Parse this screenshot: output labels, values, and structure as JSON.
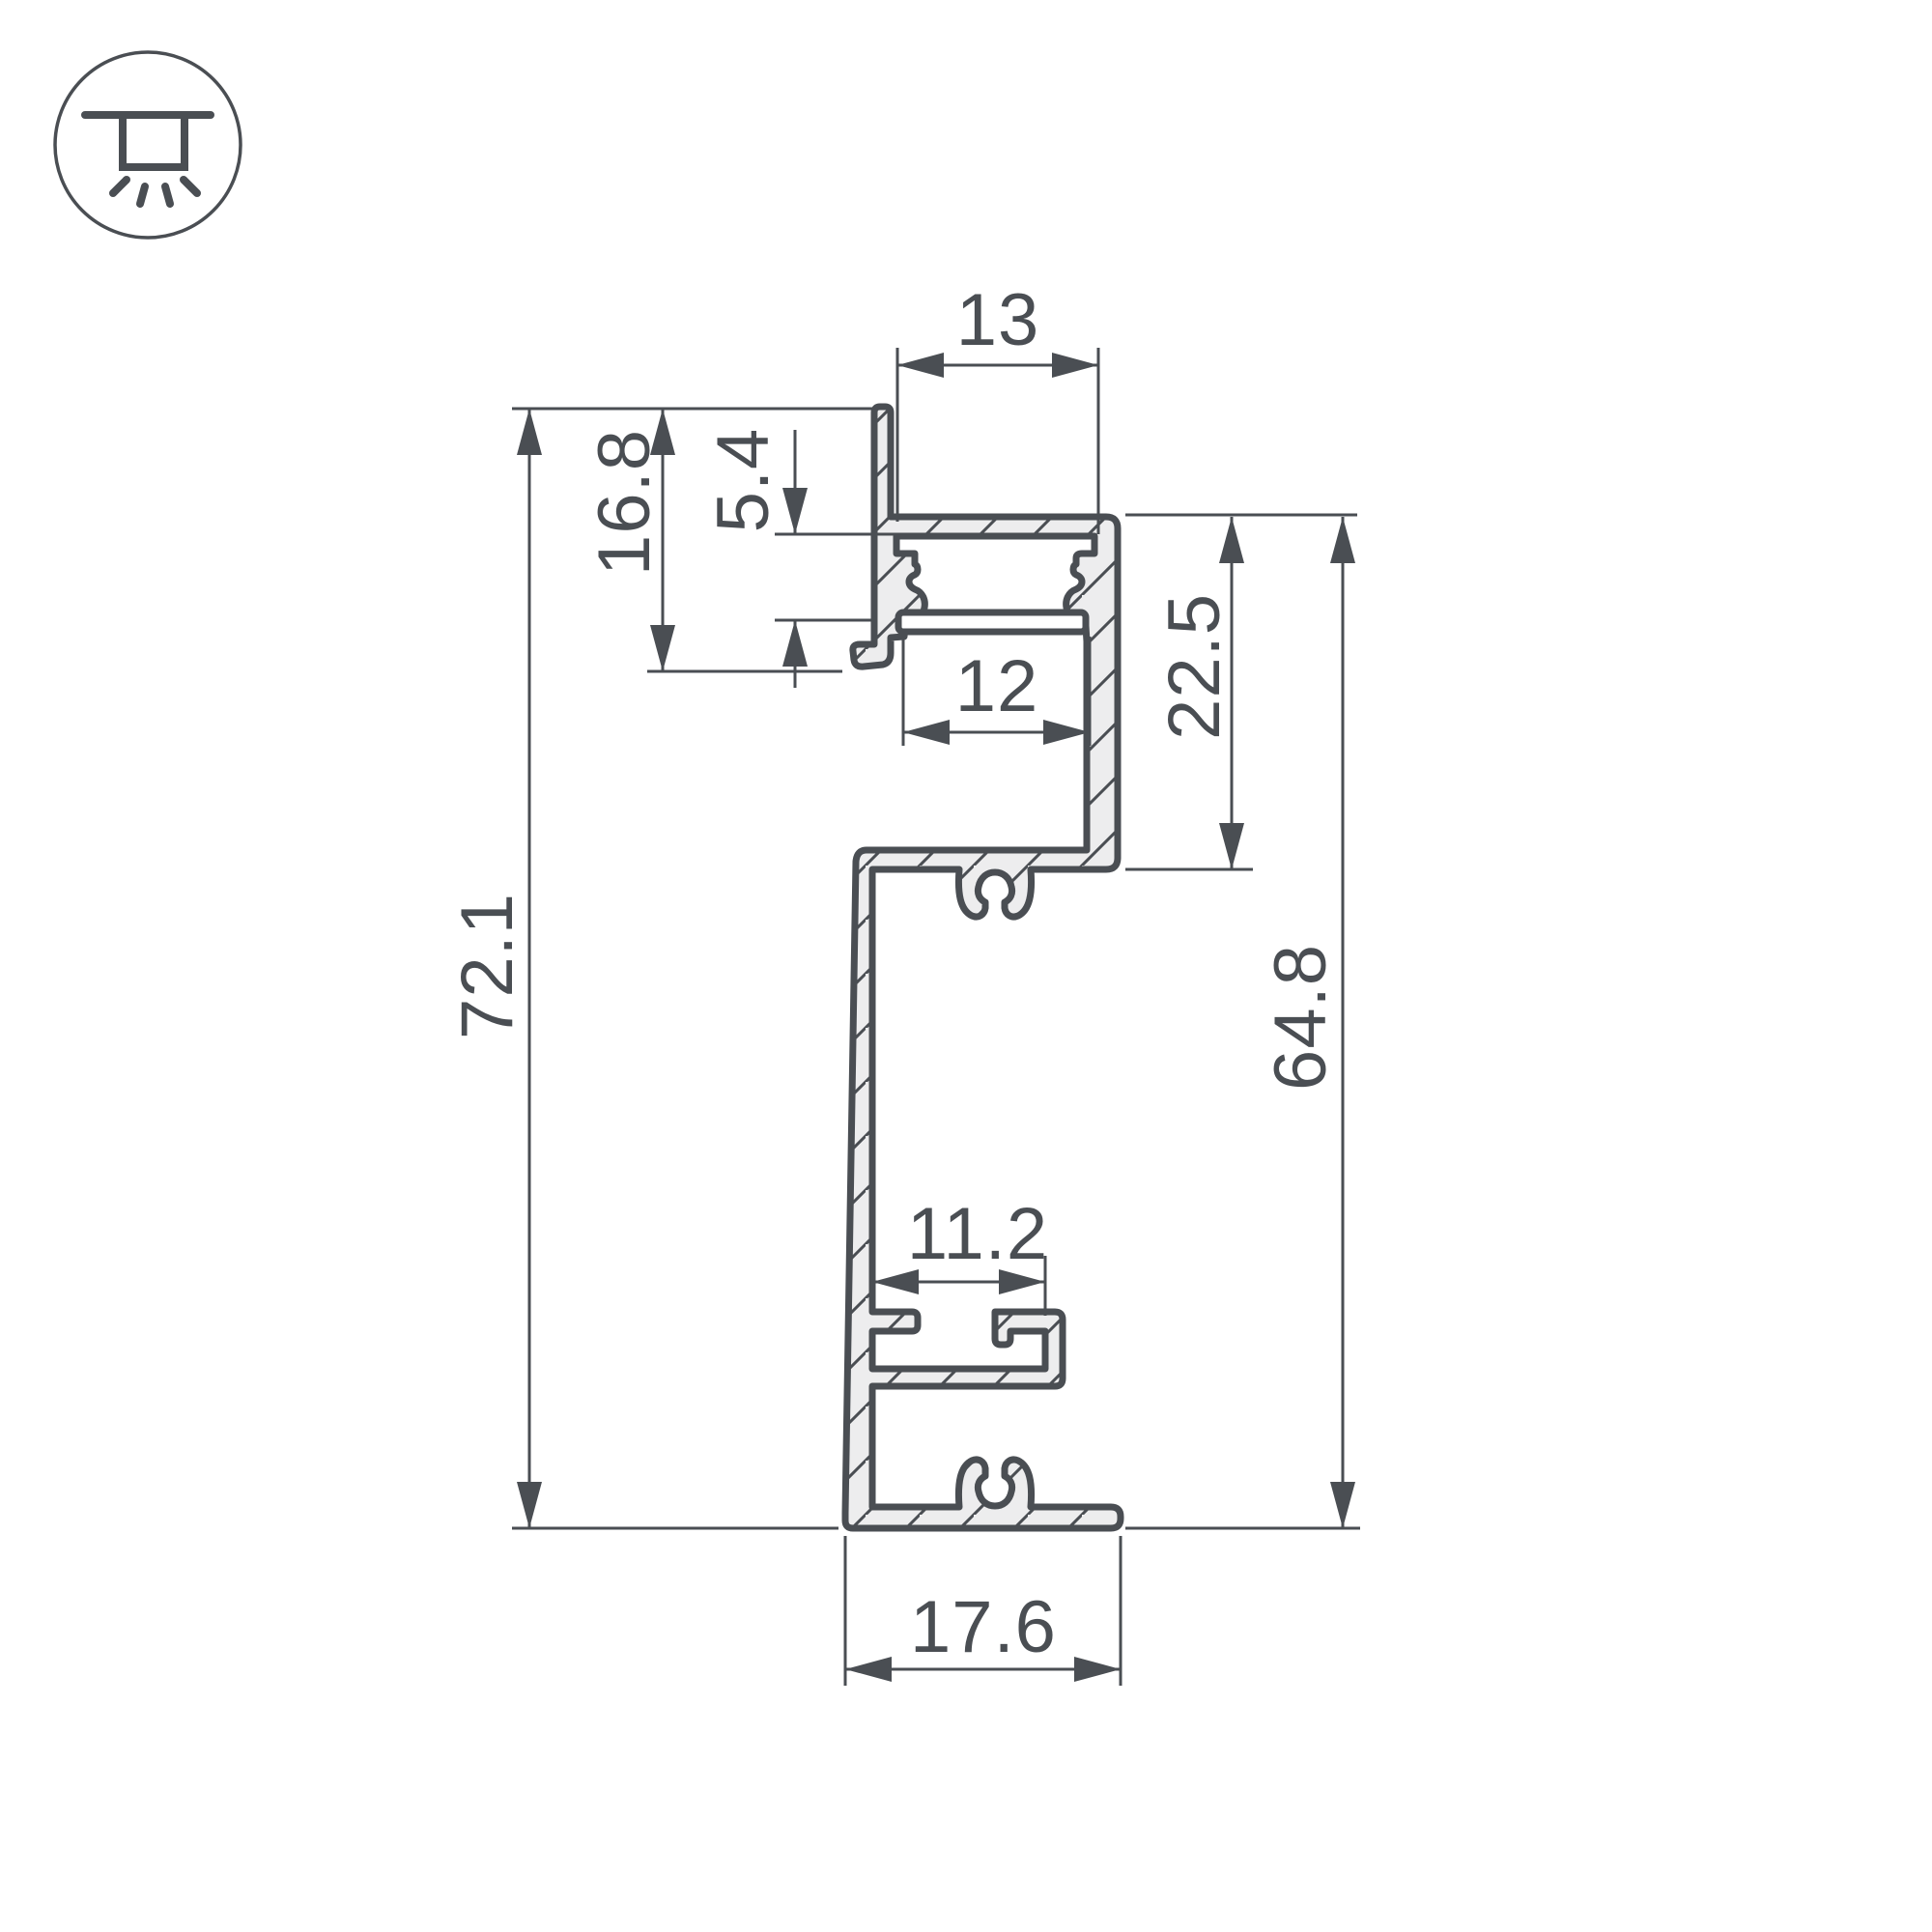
{
  "page": {
    "background": "#ffffff"
  },
  "icon": {
    "type": "recessed-ceiling-light",
    "color": "#4a4e53"
  },
  "drawing": {
    "type": "aluminum-led-profile-cross-section",
    "line_color": "#4a4e53",
    "fill_color": "#ededee",
    "dimensions": {
      "top_channel_width": "13",
      "flange_height": "16.8",
      "led_recess_depth": "5.4",
      "opening_width": "12",
      "upper_section_height": "22.5",
      "overall_height": "72.1",
      "body_height": "64.8",
      "mount_slot_width": "11.2",
      "base_width": "17.6"
    }
  }
}
